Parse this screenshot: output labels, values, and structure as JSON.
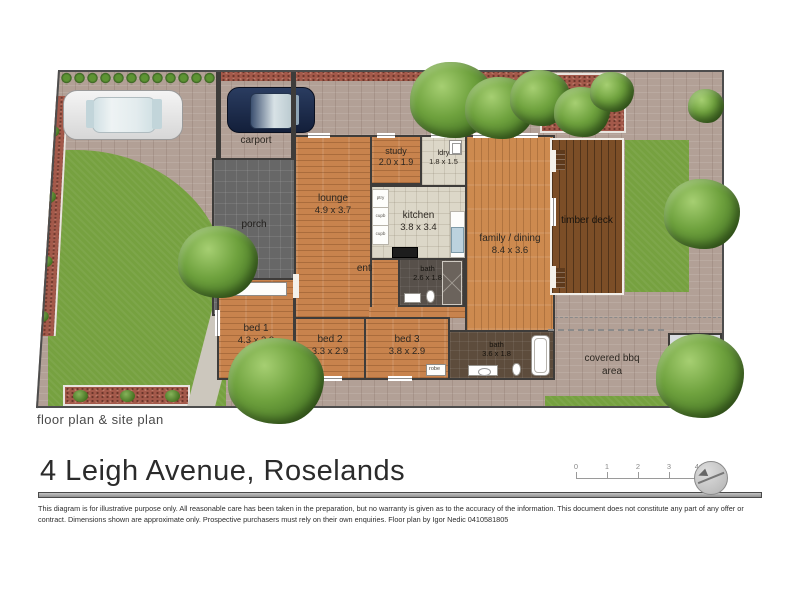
{
  "footer": {
    "caption": "floor plan & site plan",
    "title": "4 Leigh Avenue, Roselands",
    "disclaimer": "This diagram is for illustrative purpose only. All reasonable care has been taken in the preparation, but no warranty is given as to the accuracy of the information. This document does not constitute any part of any offer or contract. Dimensions shown are approximate only. Prospective purchasers must rely on their own enquiries. Floor plan by Igor Nedic 0410581805",
    "scale_ticks": [
      "0",
      "1",
      "2",
      "3",
      "4m"
    ]
  },
  "rooms": {
    "carport": {
      "name": "carport"
    },
    "porch": {
      "name": "porch"
    },
    "lounge": {
      "name": "lounge",
      "dims": "4.9 x 3.7"
    },
    "study": {
      "name": "study",
      "dims": "2.0 x 1.9"
    },
    "laundry": {
      "name": "ldry",
      "dims": "1.8 x 1.5"
    },
    "kitchen": {
      "name": "kitchen",
      "dims": "3.8 x 3.4"
    },
    "family": {
      "name": "family / dining",
      "dims": "8.4 x 3.6"
    },
    "entry": {
      "name": "entry"
    },
    "bath1": {
      "name": "bath",
      "dims": "2.6 x 1.8"
    },
    "bed1": {
      "name": "bed 1",
      "dims": "4.3 x 3.3"
    },
    "bed2": {
      "name": "bed 2",
      "dims": "3.3 x 2.9"
    },
    "bed3": {
      "name": "bed 3",
      "dims": "3.8 x 2.9"
    },
    "bath2": {
      "name": "bath",
      "dims": "3.6 x 1.8"
    },
    "deck": {
      "name": "timber deck"
    },
    "bbq": {
      "line1": "covered bbq",
      "line2": "area"
    },
    "store": {
      "line1": "store/",
      "line2": "workshop",
      "dims": "2.8 x 2.2"
    },
    "robe": "robe",
    "kitchen_units": [
      "ptry",
      "cupb",
      "cupb"
    ]
  },
  "colors": {
    "paving": "#b2a096",
    "lawn": "#76a140",
    "mulch": "#a3594a",
    "wood_floor": "#c8834d",
    "timber_deck": "#7c4e27",
    "wall": "#3e3c3a",
    "kitchen_tile": "#dcd7c8",
    "porch_tile": "#676767",
    "store_fill": "#d9dde1",
    "title_text": "#2b2b2b"
  }
}
